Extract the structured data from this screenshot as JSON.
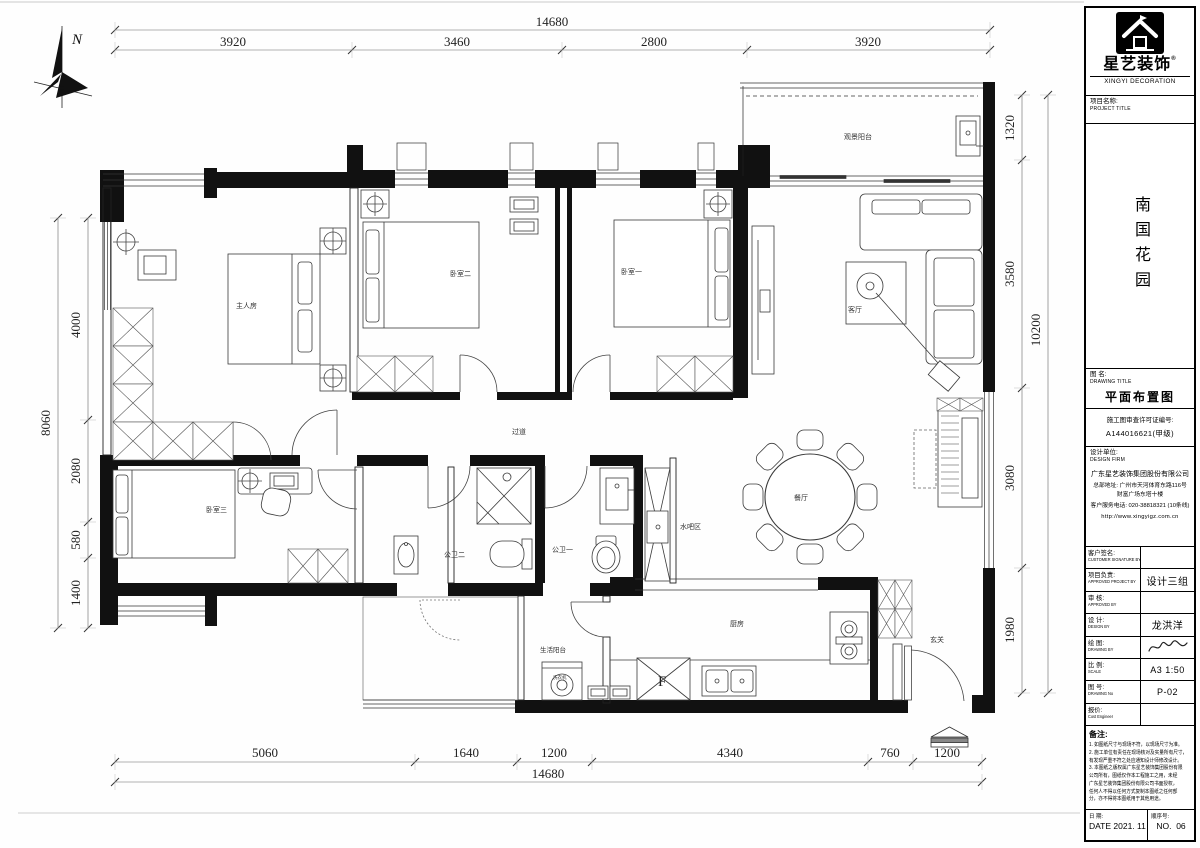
{
  "plan": {
    "north_label": "N",
    "rooms": {
      "master": "主人房",
      "bedroom2": "卧室二",
      "bedroom1": "卧室一",
      "bedroom3": "卧室三",
      "living": "客厅",
      "dining": "餐厅",
      "kitchen": "厨房",
      "entry": "玄关",
      "corridor": "过道",
      "bath1": "公卫一",
      "bath2": "公卫二",
      "waterbar": "水吧区",
      "utility_balcony": "生活阳台",
      "view_balcony": "观景阳台",
      "washer": "洗衣机",
      "fridge": "F"
    },
    "dims": {
      "top_total": "14680",
      "top": [
        "3920",
        "3460",
        "2800",
        "3920"
      ],
      "bottom": [
        "5060",
        "1640",
        "1200",
        "4340",
        "760",
        "1200"
      ],
      "bottom_total": "14680",
      "left": [
        "4000",
        "2080",
        "580",
        "1400"
      ],
      "left_total": "8060",
      "right": [
        "1320",
        "3580",
        "3080",
        "1980"
      ],
      "right_total": "10200"
    }
  },
  "title_block": {
    "brand_cn": "星艺装饰",
    "brand_mark": "®",
    "brand_en": "XINGYI DECORATION",
    "project_label_cn": "项目名称:",
    "project_label_en": "PROJECT TITLE",
    "project_name": "南国花园",
    "drawing_label_cn": "图 名:",
    "drawing_label_en": "DRAWING TITLE",
    "drawing_title": "平面布置图",
    "license_label": "施工图审查许可证编号:",
    "license_no": "A144016621(甲级)",
    "firm_label_cn": "设计单位:",
    "firm_label_en": "DESIGN FIRM",
    "firm_name": "广东星艺装饰集团股份有限公司",
    "firm_addr1": "总部地址: 广州市天河体育东路116号",
    "firm_addr2": "财富广场东塔十楼",
    "firm_phone": "客户服务电话: 020-38818321 (10条线)",
    "firm_web": "http://www.xingyigz.com.cn",
    "rows": [
      {
        "cn": "客户签名:",
        "en": "CUSTOMER SIGNATURE BY",
        "value": ""
      },
      {
        "cn": "项目负责:",
        "en": "APPROVED PROJECT BY",
        "value": "设计三组"
      },
      {
        "cn": "审 核:",
        "en": "APPROVED BY",
        "value": ""
      },
      {
        "cn": "设 计:",
        "en": "DESIGN BY",
        "value": "龙洪洋"
      },
      {
        "cn": "绘 图:",
        "en": "DRAWING BY",
        "value": ""
      },
      {
        "cn": "比 例:",
        "en": "SCALE",
        "value": "A3 1:50"
      },
      {
        "cn": "图 号:",
        "en": "DRAWING No",
        "value": "P-02"
      },
      {
        "cn": "报价:",
        "en": "Cost Engineer",
        "value": ""
      }
    ],
    "notes_title": "备注:",
    "notes": [
      "1. 如图纸尺寸与现场不符，以现场尺寸为准。",
      "2. 施工单位有责任在现场核对及实量所有尺寸，",
      "有发现严重不符之处应通知设计师修改设计。",
      "3. 本图纸之版权属广东星艺装饰集团股份有限",
      "公司所有，图纸仅作本工程施工之用，未经",
      "广东星艺装饰集团股份有限公司书面授权，",
      "任何人不得以任何方式复制本图纸之任何部",
      "分，亦不得将本图纸用于其他用途。"
    ],
    "date_label_cn": "日 期:",
    "date_label_en": "DATE",
    "date_value": "2021. 11",
    "no_label_cn": "顺序号:",
    "no_label_en": "NO.",
    "no_value": "06"
  }
}
